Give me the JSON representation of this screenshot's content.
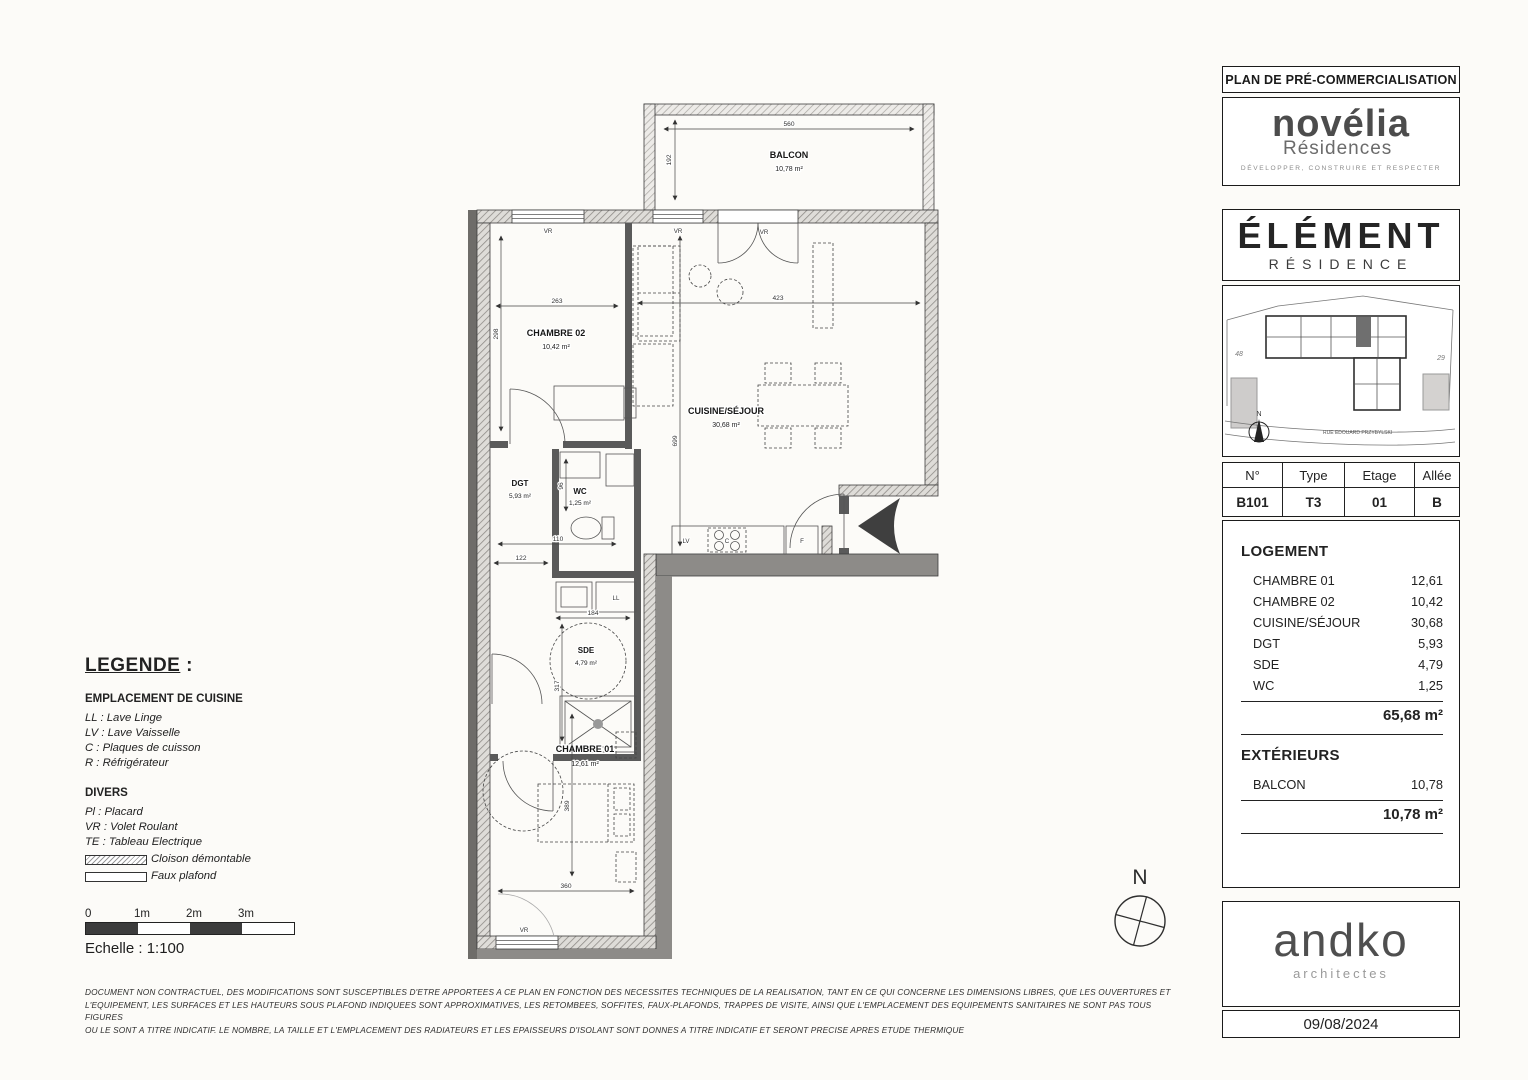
{
  "header": {
    "title": "PLAN DE PRÉ-COMMERCIALISATION"
  },
  "novelia": {
    "name": "novélia",
    "sub": "Résidences",
    "tagline": "DÉVELOPPER, CONSTRUIRE ET RESPECTER"
  },
  "element": {
    "name": "ÉLÉMENT",
    "sub": "RÉSIDENCE"
  },
  "site_map": {
    "parcel_left": "48",
    "parcel_right": "29",
    "street": "RUE EDOUARD PRZYBYLSKI",
    "north": "N"
  },
  "unit": {
    "headers": {
      "num": "N°",
      "type": "Type",
      "floor": "Etage",
      "alley": "Allée"
    },
    "values": {
      "num": "B101",
      "type": "T3",
      "floor": "01",
      "alley": "B"
    }
  },
  "logement": {
    "title": "LOGEMENT",
    "rows": [
      {
        "label": "CHAMBRE 01",
        "value": "12,61"
      },
      {
        "label": "CHAMBRE 02",
        "value": "10,42"
      },
      {
        "label": "CUISINE/SÉJOUR",
        "value": "30,68"
      },
      {
        "label": "DGT",
        "value": "5,93"
      },
      {
        "label": "SDE",
        "value": "4,79"
      },
      {
        "label": "WC",
        "value": "1,25"
      }
    ],
    "total": "65,68 m²"
  },
  "exterieurs": {
    "title": "EXTÉRIEURS",
    "rows": [
      {
        "label": "BALCON",
        "value": "10,78"
      }
    ],
    "total": "10,78 m²"
  },
  "architect": {
    "name": "andko",
    "sub": "architectes",
    "date": "09/08/2024"
  },
  "legend": {
    "title": "LEGENDE",
    "colon": " :",
    "cuisine_title": "EMPLACEMENT DE CUISINE",
    "cuisine_items": [
      "LL : Lave Linge",
      "LV : Lave Vaisselle",
      "C : Plaques de cuisson",
      "R : Réfrigérateur"
    ],
    "divers_title": "DIVERS",
    "divers_items": [
      "Pl :  Placard",
      "VR : Volet Roulant",
      "TE : Tableau Electrique"
    ],
    "swatch_hatch_label": "Cloison démontable",
    "swatch_plain_label": "Faux plafond"
  },
  "scale": {
    "ticks": [
      "0",
      "1m",
      "2m",
      "3m"
    ],
    "label": "Echelle : 1:100"
  },
  "disclaimer": {
    "line1": "DOCUMENT NON CONTRACTUEL, DES MODIFICATIONS SONT SUSCEPTIBLES D'ETRE APPORTEES A CE PLAN EN FONCTION DES NECESSITES TECHNIQUES DE LA REALISATION, TANT EN CE QUI CONCERNE LES DIMENSIONS LIBRES, QUE LES OUVERTURES ET",
    "line2": "L'EQUIPEMENT, LES SURFACES ET LES HAUTEURS SOUS PLAFOND INDIQUEES SONT APPROXIMATIVES, LES RETOMBEES, SOFFITES, FAUX-PLAFONDS, TRAPPES DE VISITE, AINSI QUE L'EMPLACEMENT DES EQUIPEMENTS SANITAIRES NE SONT PAS TOUS FIGURES",
    "line3": "OU LE SONT A TITRE INDICATIF. LE NOMBRE, LA TAILLE ET L'EMPLACEMENT DES RADIATEURS ET LES EPAISSEURS D'ISOLANT SONT DONNES A TITRE INDICATIF ET SERONT PRECISE APRES ETUDE THERMIQUE",
    "north": "N"
  },
  "plan": {
    "rooms": {
      "balcon": {
        "name": "BALCON",
        "area": "10,78 m²"
      },
      "chambre02": {
        "name": "CHAMBRE 02",
        "area": "10,42 m²"
      },
      "cuisine": {
        "name": "CUISINE/SÉJOUR",
        "area": "30,68 m²"
      },
      "dgt": {
        "name": "DGT",
        "area": "5,93 m²"
      },
      "wc": {
        "name": "WC",
        "area": "1,25 m²"
      },
      "sde": {
        "name": "SDE",
        "area": "4,79 m²"
      },
      "chambre01": {
        "name": "CHAMBRE 01",
        "area": "12,61 m²"
      }
    },
    "dims": {
      "balcon_w": "560",
      "balcon_h": "192",
      "ch2_w": "263",
      "ch2_h": "298",
      "cuisine_w": "423",
      "cuisine_h": "699",
      "wc_h": "96",
      "wc_w": "110",
      "dgt_w": "122",
      "sde_w": "184",
      "sde_h": "317",
      "ch1_h": "389",
      "ch1_w": "360"
    },
    "labels": {
      "vr": "VR",
      "ll": "LL",
      "lv": "LV",
      "c": "C",
      "f": "F"
    }
  },
  "colors": {
    "wall_gray": "#8d8b88",
    "accent_dark": "#3f3f3f"
  }
}
